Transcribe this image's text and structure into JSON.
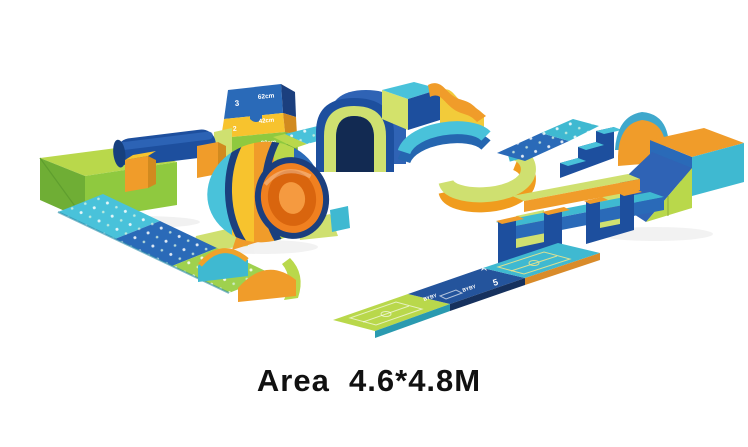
{
  "image": {
    "type": "product-photo",
    "subject": "children indoor soft-play foam playground set",
    "caption": "Area  4.6*4.8M"
  },
  "labels": {
    "climber": {
      "tier3_number": "3",
      "tier3_height": "62cm",
      "tier2_number": "2",
      "tier2_height": "42cm",
      "tier1_height": "22cm"
    },
    "mats": {
      "brand_left": "BYBY",
      "brand_right": "BYBY",
      "game_number": "5"
    }
  },
  "colors": {
    "navy": "#1b3f7e",
    "blue": "#1d4f9e",
    "blue_mid": "#2a6ab8",
    "sky_blue": "#2f63b5",
    "teal": "#3fb9d1",
    "teal_light": "#49c2da",
    "lime": "#b9d84b",
    "lime_pale": "#cfe070",
    "green": "#8fc93f",
    "orange": "#f09c2a",
    "orange_deep": "#f08020",
    "yellow": "#f7c32e",
    "caption_text": "#111111",
    "background": "#ffffff"
  }
}
